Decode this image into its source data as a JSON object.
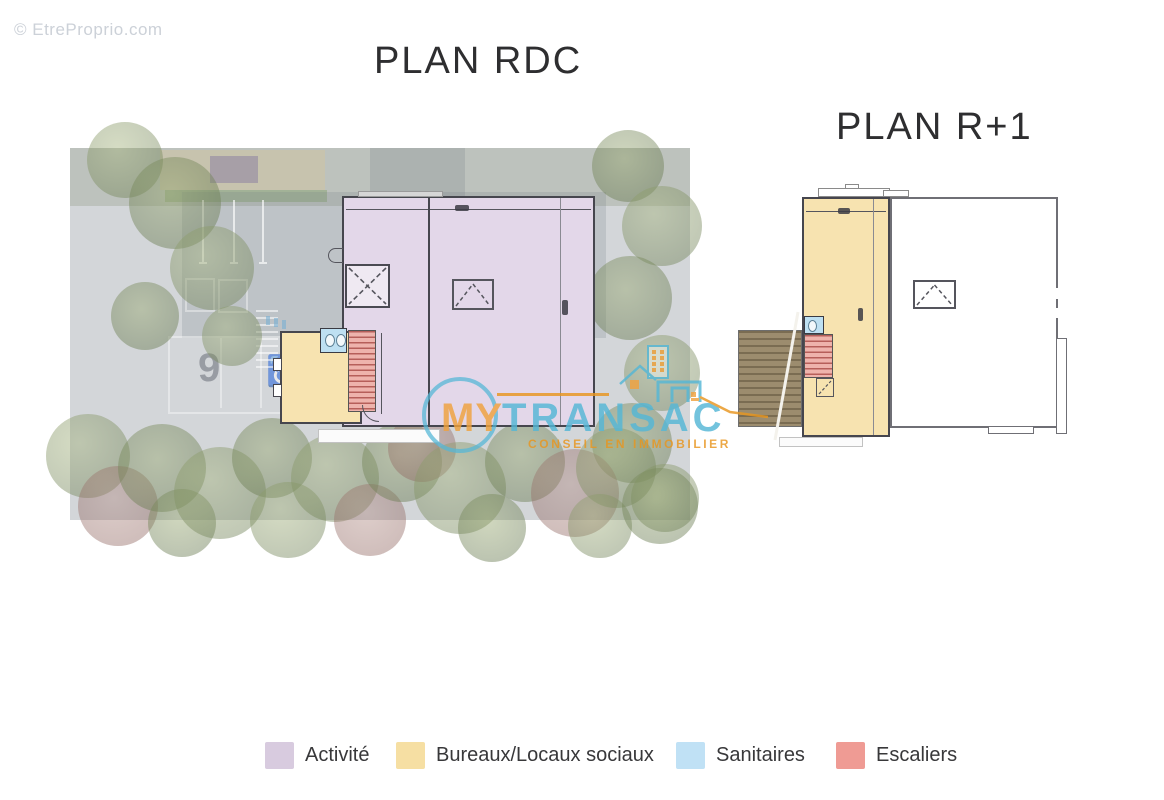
{
  "watermark": "© EtreProprio.com",
  "titles": {
    "rdc": "PLAN RDC",
    "r1": "PLAN R+1"
  },
  "logo": {
    "word1": "MY",
    "word2": "TRANSAC",
    "tagline": "CONSEIL EN IMMOBILIER",
    "colors": {
      "orange": "#f0a23e",
      "blue": "#55b7d6"
    }
  },
  "legend": {
    "items": [
      {
        "label": "Activité",
        "color": "#d8cbdf"
      },
      {
        "label": "Bureaux/Locaux sociaux",
        "color": "#f6dfa3"
      },
      {
        "label": "Sanitaires",
        "color": "#c0e1f5"
      },
      {
        "label": "Escaliers",
        "color": "#ef9b94"
      }
    ]
  },
  "plan_colors": {
    "activite": "#e3d7e9",
    "bureaux": "#f7e3b0",
    "sanitaires": "#bee0f2",
    "escaliers": "#edaaa2"
  },
  "site": {
    "handicap_symbol": "♿",
    "stall_number": "9"
  }
}
